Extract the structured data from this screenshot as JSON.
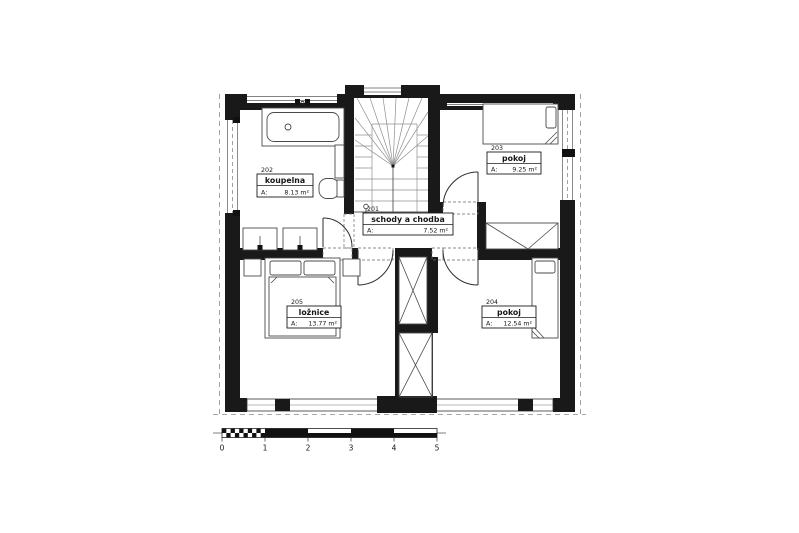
{
  "plan": {
    "type": "floor-plan",
    "colors": {
      "wall": "#191919",
      "background": "#ffffff"
    },
    "rooms": [
      {
        "id": "201",
        "name": "schody a chodba",
        "area_label": "A:",
        "area": "7.52 m²"
      },
      {
        "id": "202",
        "name": "koupelna",
        "area_label": "A:",
        "area": "8.13 m²"
      },
      {
        "id": "203",
        "name": "pokoj",
        "area_label": "A:",
        "area": "9.25 m²"
      },
      {
        "id": "204",
        "name": "pokoj",
        "area_label": "A:",
        "area": "12.54 m²"
      },
      {
        "id": "205",
        "name": "ložnice",
        "area_label": "A:",
        "area": "13.77 m²"
      }
    ],
    "scale_bar": {
      "ticks": [
        "0",
        "1",
        "2",
        "3",
        "4",
        "5"
      ]
    }
  }
}
